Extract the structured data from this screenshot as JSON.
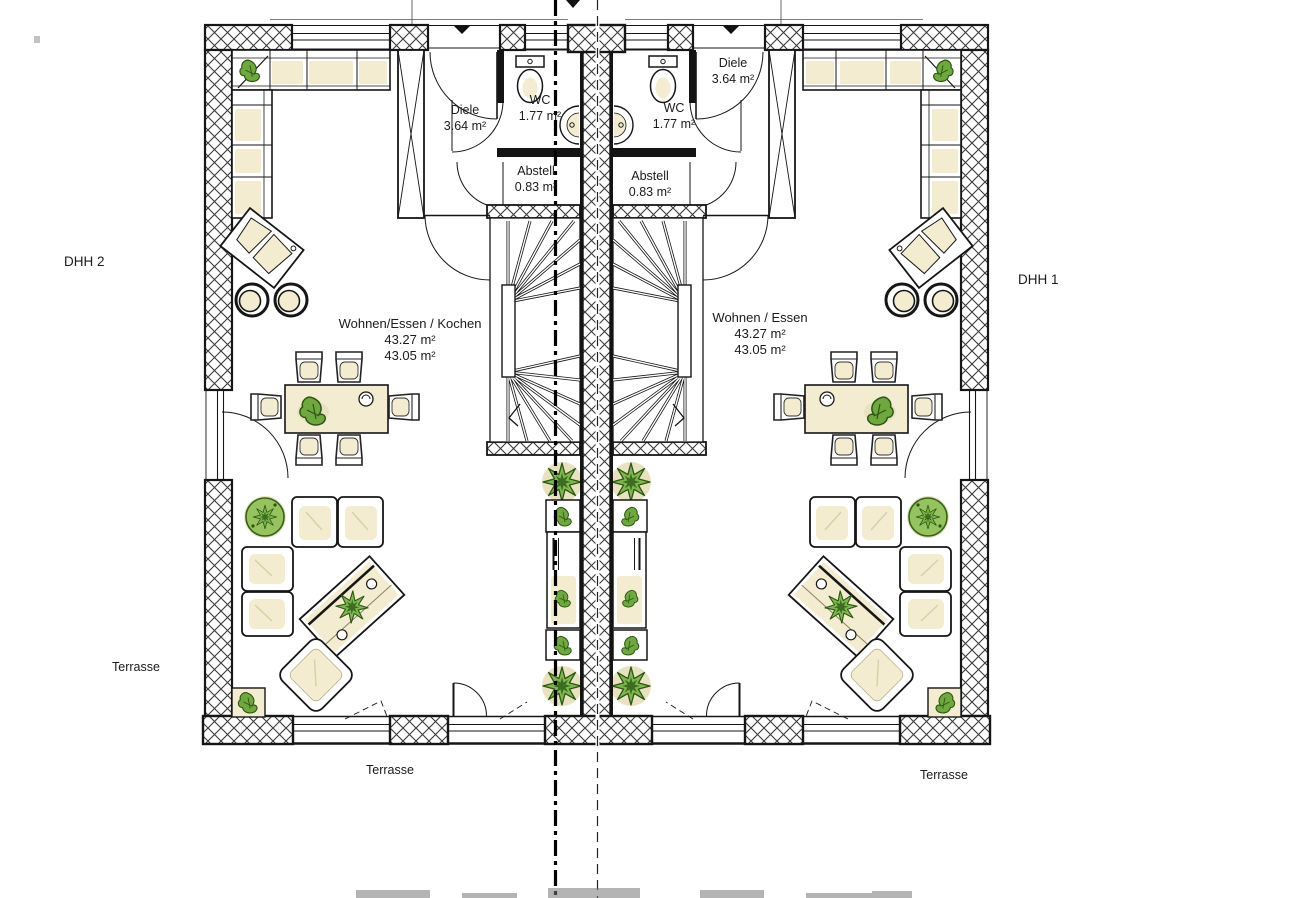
{
  "plan": {
    "houses": {
      "left": {
        "id_label": "DHH 2",
        "diele": {
          "name": "Diele",
          "area": "3.64 m²"
        },
        "wc": {
          "name": "WC",
          "area": "1.77 m²"
        },
        "abstell": {
          "name": "Abstell",
          "area": "0.83 m²"
        },
        "living": {
          "name": "Wohnen/Essen / Kochen",
          "area_a": "43.27 m²",
          "area_b": "43.05 m²"
        }
      },
      "right": {
        "id_label": "DHH 1",
        "diele": {
          "name": "Diele",
          "area": "3.64 m²"
        },
        "wc": {
          "name": "WC",
          "area": "1.77 m²"
        },
        "abstell": {
          "name": "Abstell",
          "area": "0.83 m²"
        },
        "living": {
          "name": "Wohnen / Essen",
          "area_a": "43.27 m²",
          "area_b": "43.05 m²"
        }
      }
    },
    "terraces": {
      "left": "Terrasse",
      "bottom_left": "Terrasse",
      "bottom_right": "Terrasse"
    },
    "colors": {
      "outline": "#161616",
      "furniture_fill": "#f3ecd1",
      "furniture_shadow": "#e9e2c0",
      "plant_green": "#7fb74e",
      "plant_dark": "#2d5514"
    }
  }
}
